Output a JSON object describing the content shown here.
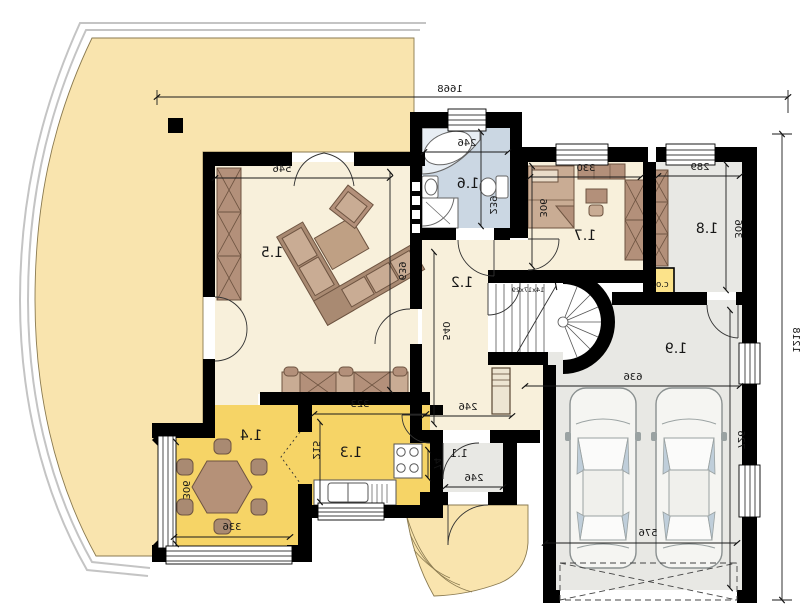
{
  "rooms": {
    "r11": "1.1",
    "r12": "1.2",
    "r13": "1.3",
    "r14": "1.4",
    "r15": "1.5",
    "r16": "1.6",
    "r17": "1.7",
    "r18": "1.8",
    "r19": "1.9"
  },
  "dims": {
    "overall_width": "1668",
    "overall_height": "1218",
    "living_width": "546",
    "living_depth": "639",
    "bath_width": "246",
    "bath_depth": "239",
    "bedroom_width": "330",
    "bedroom_depth": "306",
    "store_width": "289",
    "store_depth": "306",
    "hall_depth": "540",
    "hall_width": "246",
    "stair_note": "14x17x29",
    "garage_width": "636",
    "garage_depth": "726",
    "garage_door_width": "576",
    "vestibule_width": "246",
    "vestibule_depth": "74",
    "kitchen_width": "323",
    "kitchen_depth": "215",
    "dining_width": "336",
    "dining_depth": "306",
    "boiler_label": "c.o."
  },
  "colors": {
    "wall": "#000000",
    "floor_cream": "#F8F0DB",
    "floor_yellow": "#F6D466",
    "terrace_yellow": "#F9E4AE",
    "bath_blue": "#CBD7E3",
    "floor_gray": "#E8E8E4",
    "furniture_brown": "#B3907A",
    "furniture_light": "#C9AC94",
    "boiler_yellow": "#FCE38A",
    "car_glass": "#BFCEDA"
  }
}
